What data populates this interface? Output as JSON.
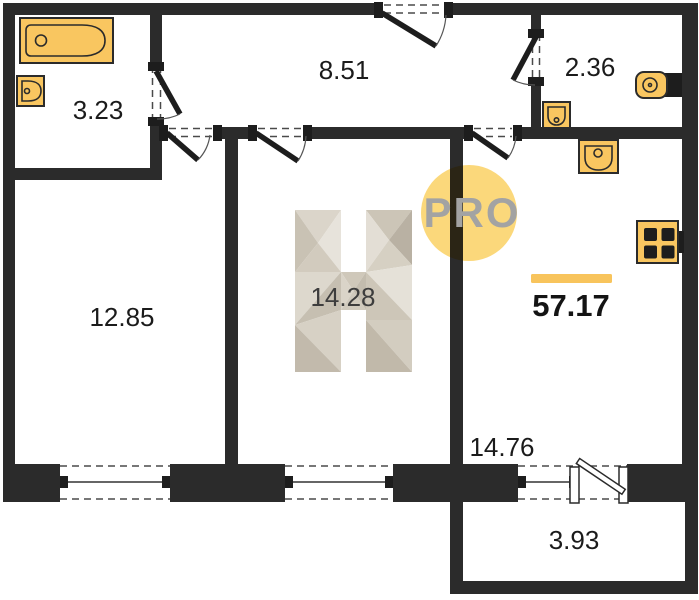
{
  "floorplan": {
    "badge": "PRO",
    "logo_letter": "H",
    "total_area": "57.17",
    "rooms": [
      {
        "name": "bathroom",
        "area": "3.23"
      },
      {
        "name": "hallway",
        "area": "8.51"
      },
      {
        "name": "toilet",
        "area": "2.36"
      },
      {
        "name": "bedroom",
        "area": "12.85"
      },
      {
        "name": "living-room",
        "area": "14.28"
      },
      {
        "name": "kitchen-living-room",
        "area": "14.76"
      },
      {
        "name": "balcony",
        "area": "3.93"
      }
    ],
    "fixtures": [
      "bathtub",
      "bathroom-sink",
      "toilet",
      "wc-sink",
      "kitchen-sink",
      "stove"
    ],
    "colors": {
      "wall": "#2b2b2b",
      "fixture": "#f9c660",
      "accent_bar": "#f8c45c",
      "badge": "#fbd87b",
      "badge_text": "#a3a3a3",
      "label_text": "#1b1b1b"
    }
  }
}
